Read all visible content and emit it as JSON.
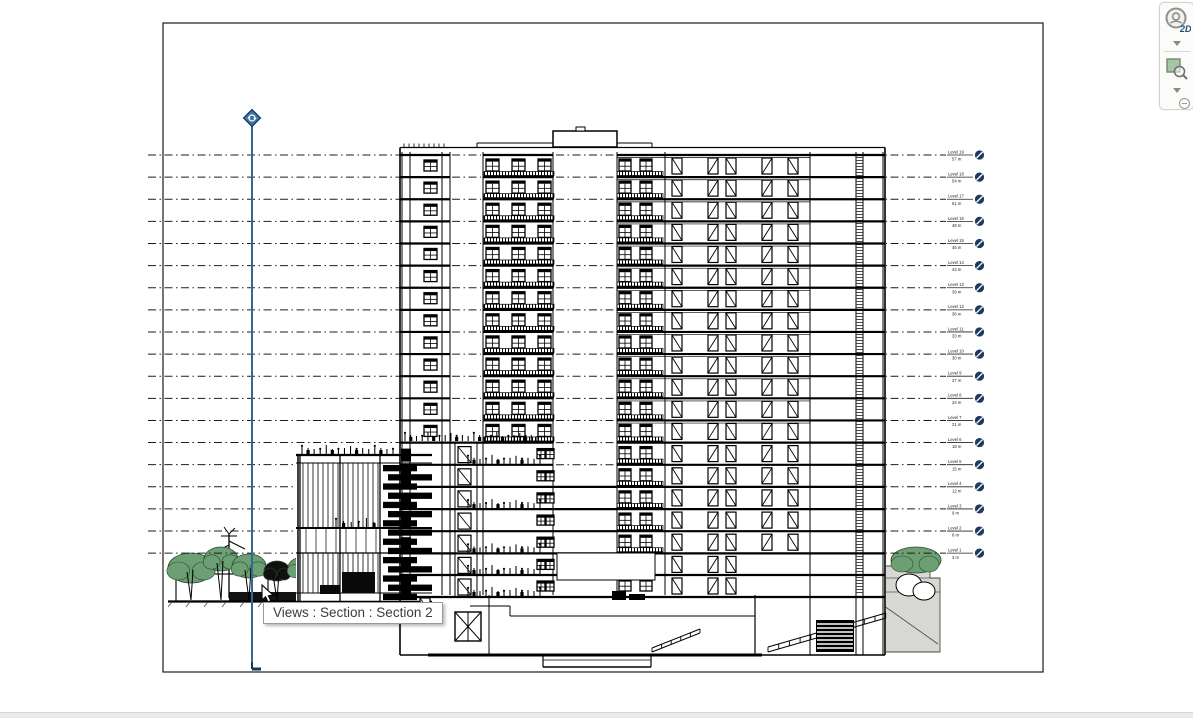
{
  "tooltip": {
    "text": "Views : Section : Section 2"
  },
  "navbar": {
    "steering_wheel_label": "2D",
    "items": [
      {
        "name": "steering-wheel-2d"
      },
      {
        "name": "steering-wheel-menu-chevron"
      },
      {
        "name": "zoom-region"
      },
      {
        "name": "zoom-menu-chevron"
      },
      {
        "name": "navbar-collapse"
      }
    ]
  },
  "viewport": {
    "x": 163,
    "y": 23,
    "w": 880,
    "h": 649,
    "border_color": "#1a1a1a"
  },
  "levels": {
    "count": 19,
    "y_top": 155,
    "spacing": 22.12,
    "x_start": 148,
    "x_end": 946,
    "label_x": 948,
    "head_cx": 979.5,
    "head_color": "#1d3a5e",
    "line_color": "#1c1c1c",
    "items": [
      {
        "name": "Level 19",
        "elevation": "57 m"
      },
      {
        "name": "Level 18",
        "elevation": "54 m"
      },
      {
        "name": "Level 17",
        "elevation": "51 m"
      },
      {
        "name": "Level 16",
        "elevation": "48 m"
      },
      {
        "name": "Level 15",
        "elevation": "45 m"
      },
      {
        "name": "Level 14",
        "elevation": "42 m"
      },
      {
        "name": "Level 13",
        "elevation": "39 m"
      },
      {
        "name": "Level 12",
        "elevation": "36 m"
      },
      {
        "name": "Level 11",
        "elevation": "33 m"
      },
      {
        "name": "Level 10",
        "elevation": "30 m"
      },
      {
        "name": "Level 9",
        "elevation": "27 m"
      },
      {
        "name": "Level 8",
        "elevation": "24 m"
      },
      {
        "name": "Level 7",
        "elevation": "21 m"
      },
      {
        "name": "Level 6",
        "elevation": "18 m"
      },
      {
        "name": "Level 5",
        "elevation": "15 m"
      },
      {
        "name": "Level 4",
        "elevation": "12 m"
      },
      {
        "name": "Level 3",
        "elevation": "9 m"
      },
      {
        "name": "Level 2",
        "elevation": "6 m"
      },
      {
        "name": "Level 1",
        "elevation": "3 m"
      }
    ]
  },
  "marker": {
    "x": 252,
    "top": 118,
    "bottom": 669,
    "line_color": "#2f6b96",
    "head_fill": "#3f74a8",
    "head_stroke": "#17365d"
  },
  "drawing": {
    "tower": {
      "left": 400,
      "right": 885,
      "roof_y": 147.5,
      "slab_top": 152,
      "bottom": 655,
      "core_left": 553,
      "core_right": 617,
      "upper_floors": 13,
      "lower_ys": [
        442.6,
        464.8,
        486.9,
        509.1,
        531.2,
        553.4,
        575,
        597
      ],
      "verticals": [
        402,
        410,
        442,
        450,
        483,
        553,
        617,
        665,
        810,
        856,
        863,
        883
      ],
      "window_xs_b": [
        486,
        512,
        538
      ],
      "window_xs_d": [
        619,
        640
      ],
      "door_xs": [
        672,
        708,
        726,
        762,
        788
      ],
      "penthouse": {
        "x": 553,
        "y": 131,
        "w": 64,
        "h": 16
      }
    },
    "podium": {
      "left": 298,
      "right": 432,
      "top": 455,
      "bottom": 602
    },
    "site": {
      "left_trees": [
        {
          "cx": 191,
          "cy": 568,
          "rx": 23,
          "ry": 15,
          "kind": "green"
        },
        {
          "cx": 221,
          "cy": 559,
          "rx": 17,
          "ry": 12,
          "kind": "green"
        },
        {
          "cx": 249,
          "cy": 566,
          "rx": 17,
          "ry": 12,
          "kind": "green"
        },
        {
          "cx": 277,
          "cy": 571,
          "rx": 13,
          "ry": 10,
          "kind": "dark"
        },
        {
          "cx": 303,
          "cy": 568,
          "rx": 15,
          "ry": 11,
          "kind": "green"
        }
      ],
      "right_tree": {
        "cx": 916,
        "cy": 560,
        "rx": 25,
        "ry": 13
      }
    }
  },
  "colors": {
    "background": "#ffffff",
    "ink": "#000000",
    "tree_green": "#6d9f74",
    "tree_edge": "#2d4a31",
    "terrain_gray": "#d7d7d3"
  }
}
